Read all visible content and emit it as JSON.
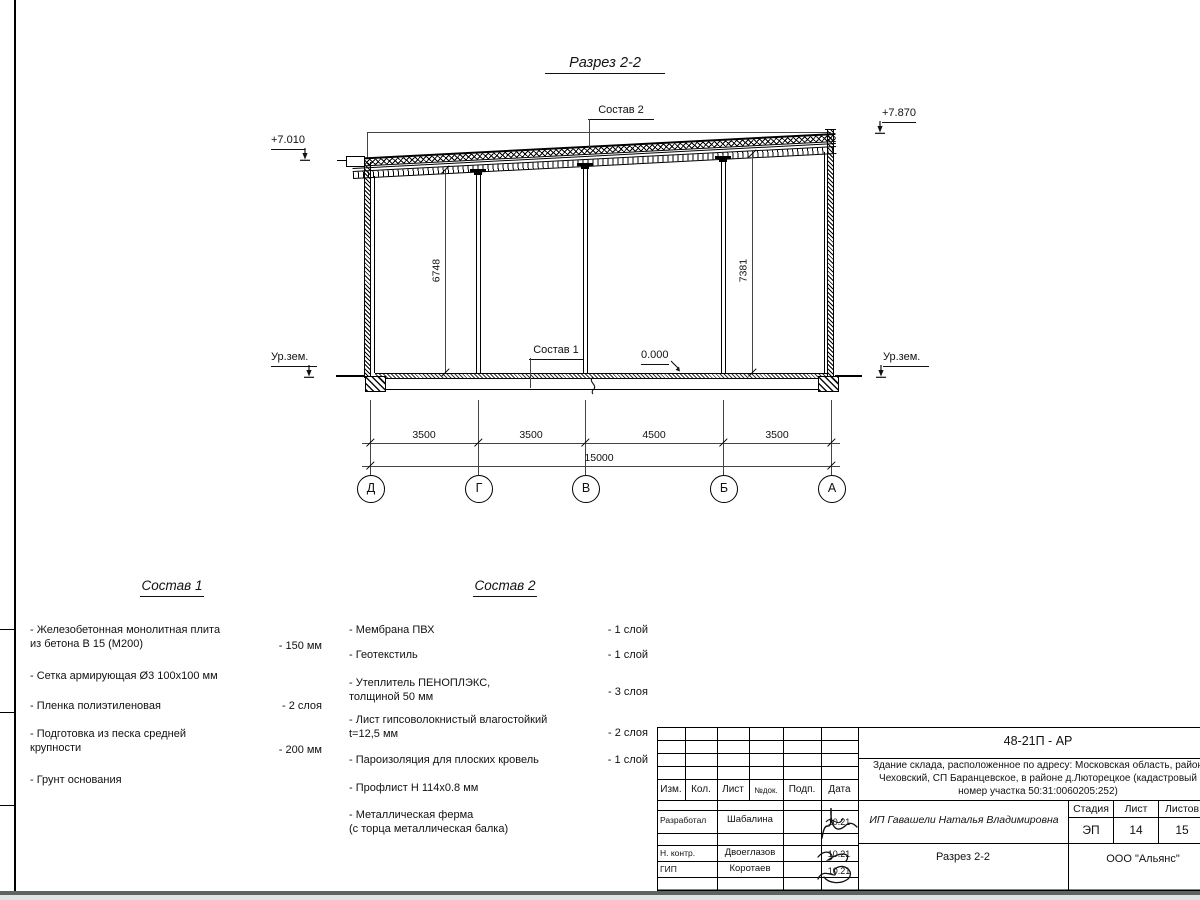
{
  "drawing": {
    "title": "Разрез 2-2",
    "elev_left": "+7.010",
    "elev_right": "+7.870",
    "ground_left": "Ур.зем.",
    "ground_right": "Ур.зем.",
    "zero_mark": "0.000",
    "label_sostav1": "Состав 1",
    "label_sostav2": "Состав 2",
    "dim_height_left": "6748",
    "dim_height_right": "7381",
    "dims_top": [
      "3500",
      "3500",
      "4500",
      "3500"
    ],
    "dim_total": "15000",
    "axes": [
      "Д",
      "Г",
      "В",
      "Б",
      "А"
    ]
  },
  "sostav1": {
    "heading": "Состав 1",
    "items": [
      {
        "label": "- Железобетонная  монолитная плита\nиз бетона В 15 (М200)",
        "value": "- 150 мм"
      },
      {
        "label": "- Сетка армирующая Ø3 100х100 мм",
        "value": ""
      },
      {
        "label": "- Пленка полиэтиленовая",
        "value": "-  2 слоя"
      },
      {
        "label": "- Подготовка из песка средней\nкрупности",
        "value": "- 200 мм"
      },
      {
        "label": "- Грунт основания",
        "value": ""
      }
    ]
  },
  "sostav2": {
    "heading": "Состав 2",
    "items": [
      {
        "label": "- Мембрана ПВХ",
        "value": "- 1 слой"
      },
      {
        "label": "- Геотекстиль",
        "value": "- 1 слой"
      },
      {
        "label": "- Утеплитель ПЕНОПЛЭКС,\nтолщиной 50 мм",
        "value": "- 3 слоя"
      },
      {
        "label": "- Лист гипсоволокнистый влагостойкий\nt=12,5 мм",
        "value": "- 2 слоя"
      },
      {
        "label": "- Пароизоляция для плоских кровель",
        "value": "- 1 слой"
      },
      {
        "label": "- Профлист Н 114х0.8 мм",
        "value": ""
      },
      {
        "label": "- Металлическая ферма\n(с торца металлическая балка)",
        "value": ""
      }
    ]
  },
  "titleblock": {
    "doc_code": "48-21П - АР",
    "description": [
      "Здание склада, расположенное по адресу: Московская область, район",
      "Чеховский, СП Баранцевское, в районе д.Люторецкое  (кадастровый",
      "номер участка 50:31:0060205:252)"
    ],
    "col_izm": "Изм.",
    "col_kol": "Кол.",
    "col_list": "Лист",
    "col_ndok": "№док.",
    "col_podp": "Подп.",
    "col_data": "Дата",
    "rows": [
      {
        "role": "Разработал",
        "name": "Шабалина",
        "date": "10.21"
      },
      {
        "role": "Н. контр.",
        "name": "Двоеглазов",
        "date": "10.21"
      },
      {
        "role": "ГИП",
        "name": "Коротаев",
        "date": "10.21"
      }
    ],
    "customer": "ИП Гавашели Наталья Владимировна",
    "stage_label": "Стадия",
    "sheet_label": "Лист",
    "sheets_label": "Листов",
    "stage": "ЭП",
    "sheet": "14",
    "sheets": "15",
    "drawing_name": "Разрез 2-2",
    "company": "ООО \"Альянс\""
  }
}
